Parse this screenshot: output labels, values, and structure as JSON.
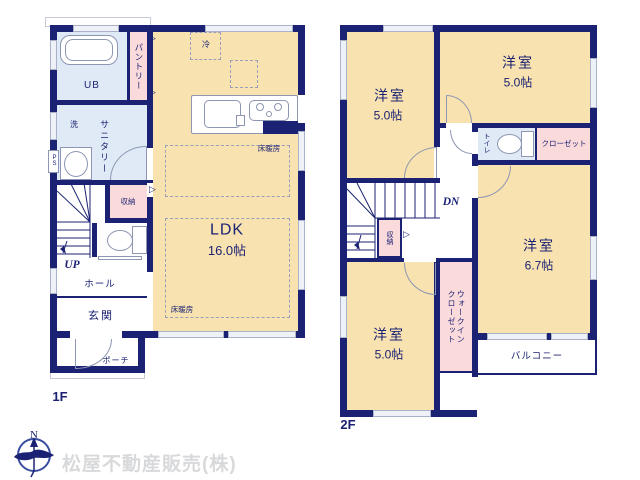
{
  "colors": {
    "wall": "#1c2273",
    "room": "#f7e2b0",
    "closet": "#fadadb",
    "wet": "#dfeaf6",
    "window": "#a9b2c6",
    "compass": "#3a4ea0",
    "logo_text": "#d8d9db"
  },
  "floor1": {
    "label": "1F",
    "ldk": {
      "name": "LDK",
      "size": "16.0帖"
    },
    "fridge": "冷",
    "floor_heating": "床暖房",
    "pantry": "パントリー",
    "bath": "UB",
    "washer": "洗",
    "sanitary": "サニタリー",
    "pipe_space": "PS",
    "storage": "収納",
    "stairs_up": "UP",
    "hall": "ホール",
    "entrance": "玄関",
    "porch": "ポーチ"
  },
  "floor2": {
    "label": "2F",
    "rooms": [
      {
        "name": "洋室",
        "size": "5.0帖"
      },
      {
        "name": "洋室",
        "size": "5.0帖"
      },
      {
        "name": "洋室",
        "size": "6.7帖"
      },
      {
        "name": "洋室",
        "size": "5.0帖"
      }
    ],
    "toilet": "トイレ",
    "closet": "クローゼット",
    "storage": "収納",
    "stairs_down": "DN",
    "walk_in_closet": "ウォークインクローゼット",
    "balcony": "バルコニー"
  },
  "footer": {
    "company": "松屋不動産販売(株)",
    "compass_north": "N"
  }
}
